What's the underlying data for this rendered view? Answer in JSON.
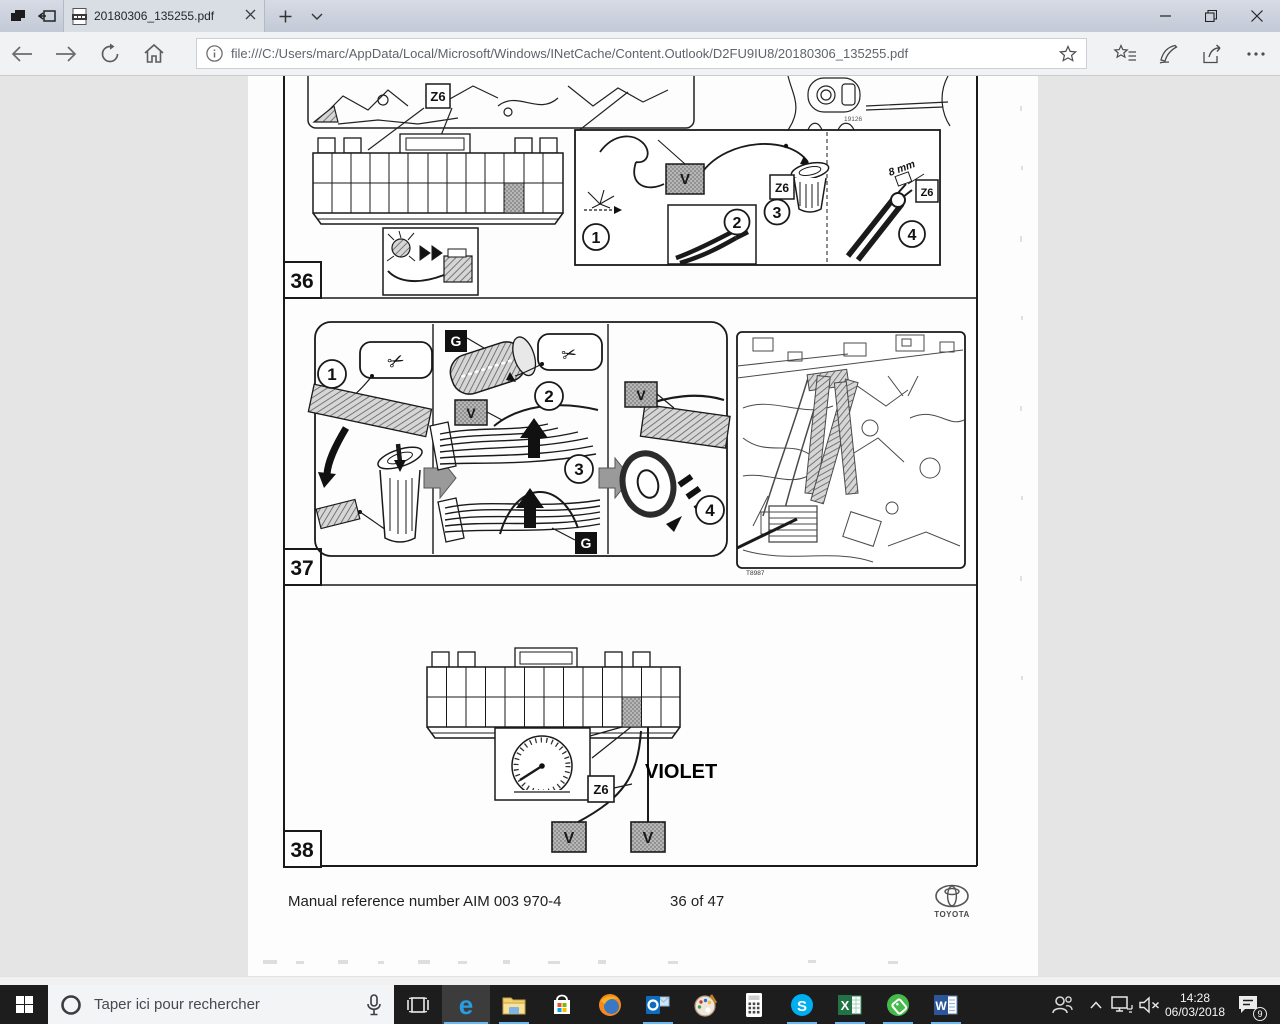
{
  "browser": {
    "tab_title": "20180306_135255.pdf",
    "url": "file:///C:/Users/marc/AppData/Local/Microsoft/Windows/INetCache/Content.Outlook/D2FU9IU8/20180306_135255.pdf"
  },
  "pdf": {
    "sections": [
      {
        "number": "36"
      },
      {
        "number": "37"
      },
      {
        "number": "38"
      }
    ],
    "step_numbers": [
      "1",
      "2",
      "3",
      "4"
    ],
    "labels": {
      "z6": "Z6",
      "v": "V",
      "g": "G",
      "eight_mm": "8 mm",
      "violet": "VIOLET",
      "fig36_code": "19126",
      "fig37_code": "T8987"
    },
    "footer": {
      "reference": "Manual reference number AIM 003 970-4",
      "page_indicator": "36 of 47",
      "brand": "TOYOTA"
    }
  },
  "taskbar": {
    "search_placeholder": "Taper ici pour rechercher",
    "apps": [
      {
        "name": "edge",
        "glyph": "e"
      },
      {
        "name": "file-explorer",
        "glyph": ""
      },
      {
        "name": "microsoft-store",
        "glyph": ""
      },
      {
        "name": "firefox",
        "glyph": ""
      },
      {
        "name": "outlook",
        "glyph": ""
      },
      {
        "name": "paint",
        "glyph": ""
      },
      {
        "name": "calculator",
        "glyph": ""
      },
      {
        "name": "skype",
        "glyph": "S"
      },
      {
        "name": "excel",
        "glyph": "X"
      },
      {
        "name": "green-tag-app",
        "glyph": ""
      },
      {
        "name": "word",
        "glyph": "W"
      }
    ],
    "clock": {
      "time": "14:28",
      "date": "06/03/2018"
    },
    "notification_badge": "9"
  },
  "colors": {
    "accent_underline": "#6cb8f0",
    "taskbar": "#1d1d1d",
    "pdf_background": "#e5e5e5",
    "titlebar_top": "#d6dbe5",
    "titlebar_bottom": "#c3c9d6"
  }
}
